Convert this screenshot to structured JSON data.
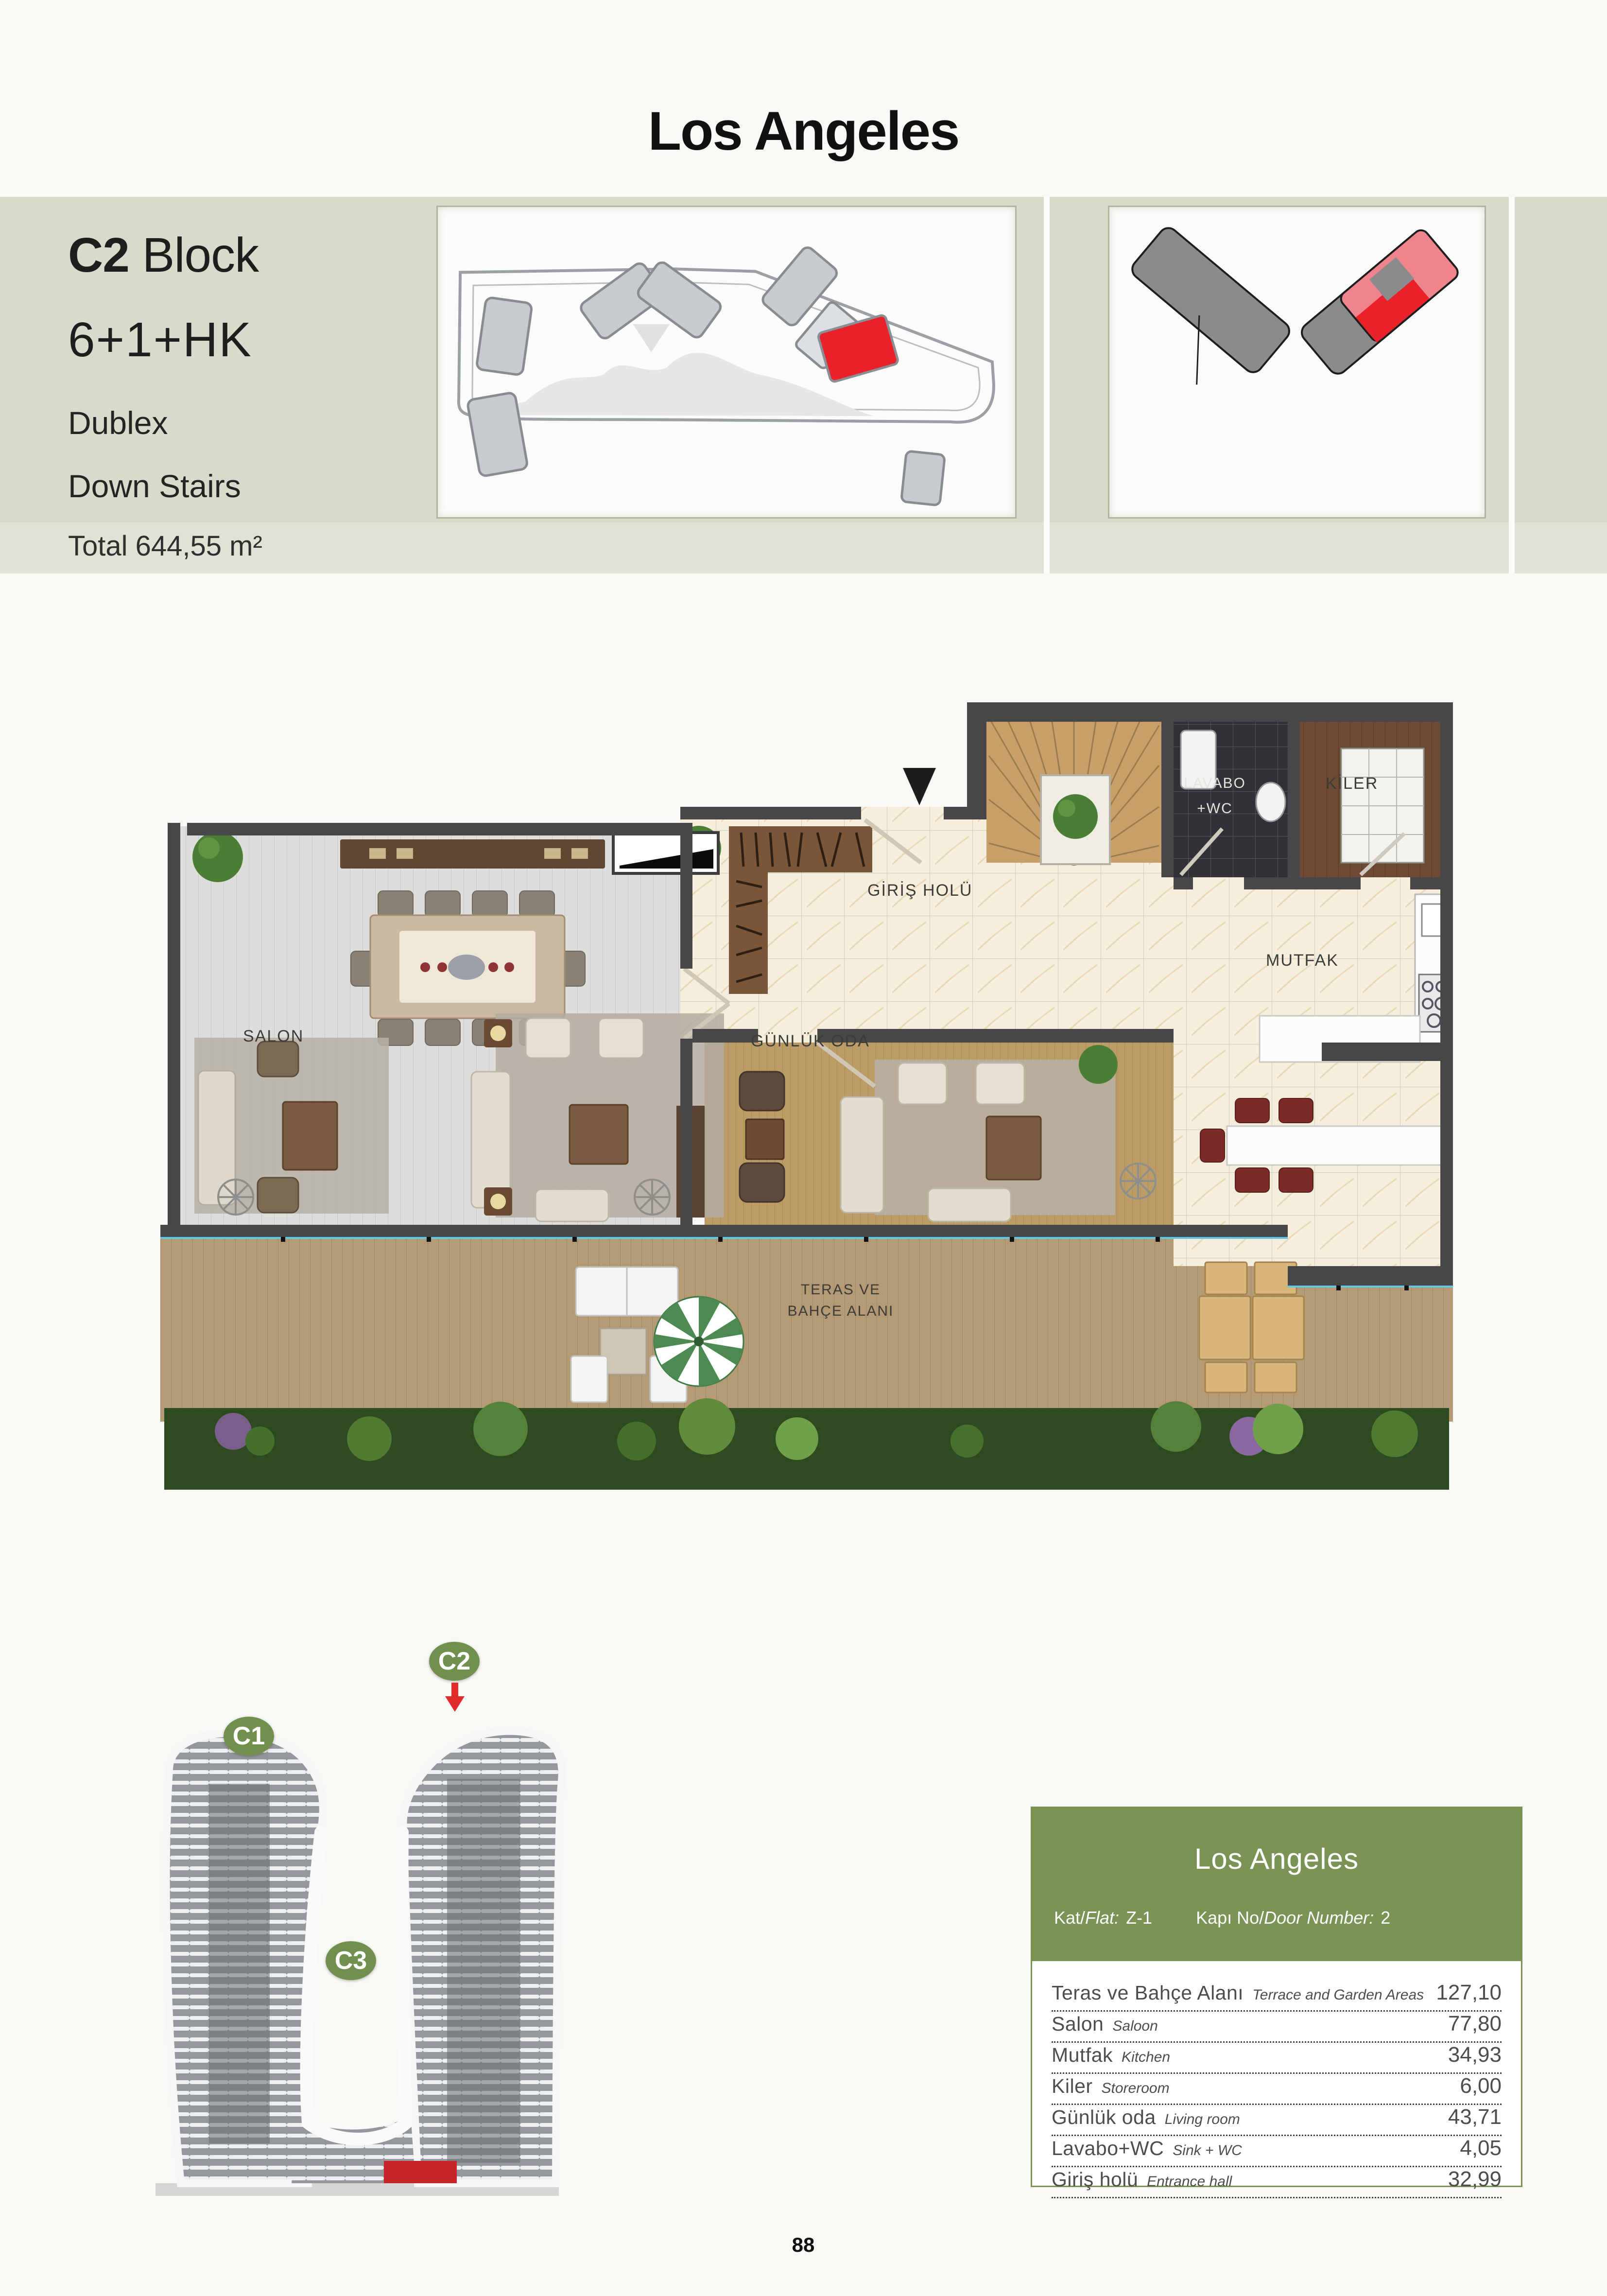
{
  "page": {
    "title": "Los Angeles",
    "page_number": "88"
  },
  "header": {
    "block_bold": "C2",
    "block_rest": " Block",
    "unit_type": "6+1+HK",
    "line_dublex": "Dublex",
    "line_stairs": "Down Stairs",
    "total_area": "Total 644,55 m²"
  },
  "floor_plan": {
    "labels": {
      "salon": "SALON",
      "giris_holu": "GİRİŞ HOLÜ",
      "lavabo": "LAVABO",
      "wc": "+WC",
      "kiler": "KİLER",
      "mutfak": "MUTFAK",
      "gunluk_oda": "GÜNLÜK ODA",
      "teras_line1": "TERAS VE",
      "teras_line2": "BAHÇE ALANI"
    }
  },
  "building": {
    "badges": [
      "C1",
      "C2",
      "C3"
    ]
  },
  "info_table": {
    "title": "Los Angeles",
    "flat_prefix": "Kat/",
    "flat_italic": "Flat:",
    "flat_value": "Z-1",
    "door_prefix": "Kapı No/",
    "door_italic": "Door Number:",
    "door_value": "2",
    "rows": [
      {
        "tr": "Teras ve Bahçe Alanı",
        "en": "Terrace and Garden Areas",
        "value": "127,10"
      },
      {
        "tr": "Salon",
        "en": "Saloon",
        "value": "77,80"
      },
      {
        "tr": "Mutfak",
        "en": "Kitchen",
        "value": "34,93"
      },
      {
        "tr": "Kiler",
        "en": "Storeroom",
        "value": "6,00"
      },
      {
        "tr": "Günlük oda",
        "en": "Living room",
        "value": "43,71"
      },
      {
        "tr": "Lavabo+WC",
        "en": "Sink + WC",
        "value": "4,05"
      },
      {
        "tr": "Giriş holü",
        "en": "Entrance hall",
        "value": "32,99"
      }
    ]
  },
  "colors": {
    "accent_green": "#7c9356",
    "badge_green": "#71904e",
    "accent_red": "#e8212a",
    "band": "#d8dbcc",
    "wall": "#47474a"
  }
}
